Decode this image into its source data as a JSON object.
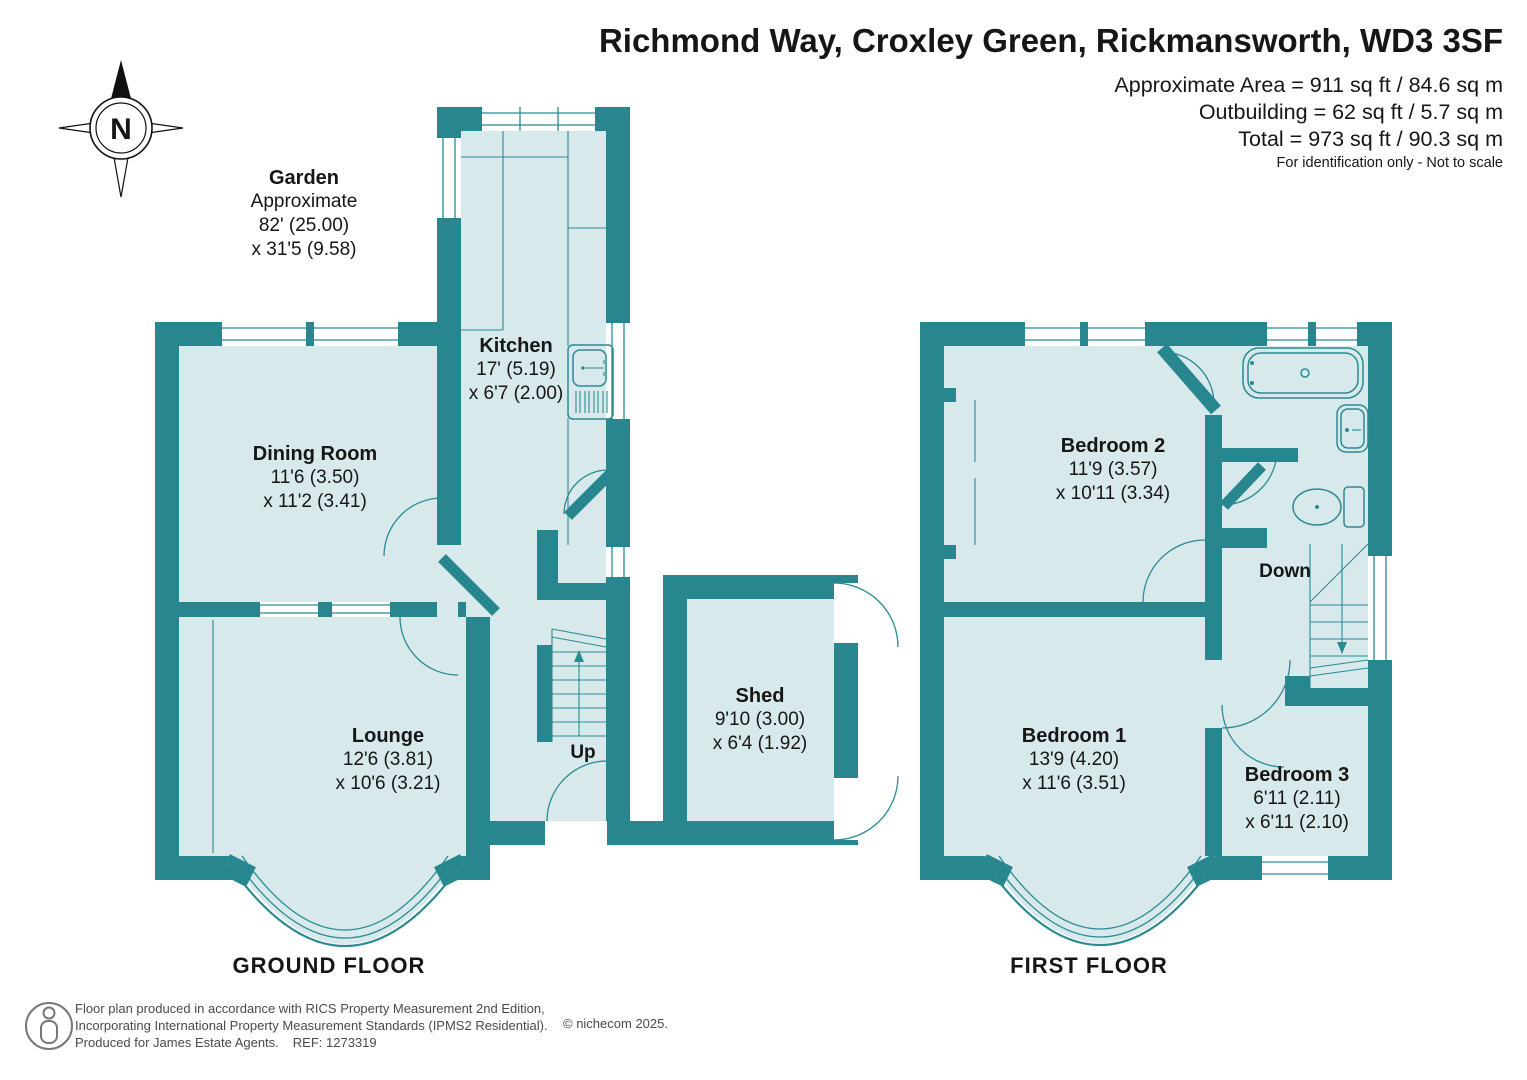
{
  "header": {
    "title": "Richmond Way, Croxley Green, Rickmansworth, WD3 3SF",
    "area_lines": [
      "Approximate Area = 911 sq ft / 84.6 sq m",
      "Outbuilding = 62 sq ft / 5.7 sq m",
      "Total = 973 sq ft / 90.3 sq m"
    ],
    "disclaimer": "For identification only - Not to scale"
  },
  "compass": {
    "north_label": "N"
  },
  "garden_note": {
    "name": "Garden",
    "line1": "Approximate",
    "line2": "82' (25.00)",
    "line3": "x 31'5 (9.58)"
  },
  "ground_floor": {
    "label": "GROUND FLOOR",
    "stairs_label": "Up",
    "rooms": [
      {
        "name": "Kitchen",
        "dim1": "17' (5.19)",
        "dim2": "x 6'7 (2.00)"
      },
      {
        "name": "Dining Room",
        "dim1": "11'6 (3.50)",
        "dim2": "x 11'2 (3.41)"
      },
      {
        "name": "Lounge",
        "dim1": "12'6 (3.81)",
        "dim2": "x 10'6 (3.21)"
      },
      {
        "name": "Shed",
        "dim1": "9'10 (3.00)",
        "dim2": "x 6'4 (1.92)"
      }
    ]
  },
  "first_floor": {
    "label": "FIRST FLOOR",
    "stairs_label": "Down",
    "rooms": [
      {
        "name": "Bedroom 2",
        "dim1": "11'9 (3.57)",
        "dim2": "x 10'11 (3.34)"
      },
      {
        "name": "Bedroom 1",
        "dim1": "13'9 (4.20)",
        "dim2": "x 11'6 (3.51)"
      },
      {
        "name": "Bedroom 3",
        "dim1": "6'11 (2.11)",
        "dim2": "x 6'11 (2.10)"
      }
    ]
  },
  "footer": {
    "line1": "Floor plan produced in accordance with RICS Property Measurement 2nd Edition,",
    "line2": "Incorporating International Property Measurement Standards (IPMS2 Residential).",
    "line3a": "Produced for James Estate Agents.",
    "line3b": "REF: 1273319",
    "copyright": "© nichecom 2025."
  },
  "colors": {
    "wall": "#27868e",
    "room": "#d8e9ec",
    "line": "#2a8b92"
  }
}
